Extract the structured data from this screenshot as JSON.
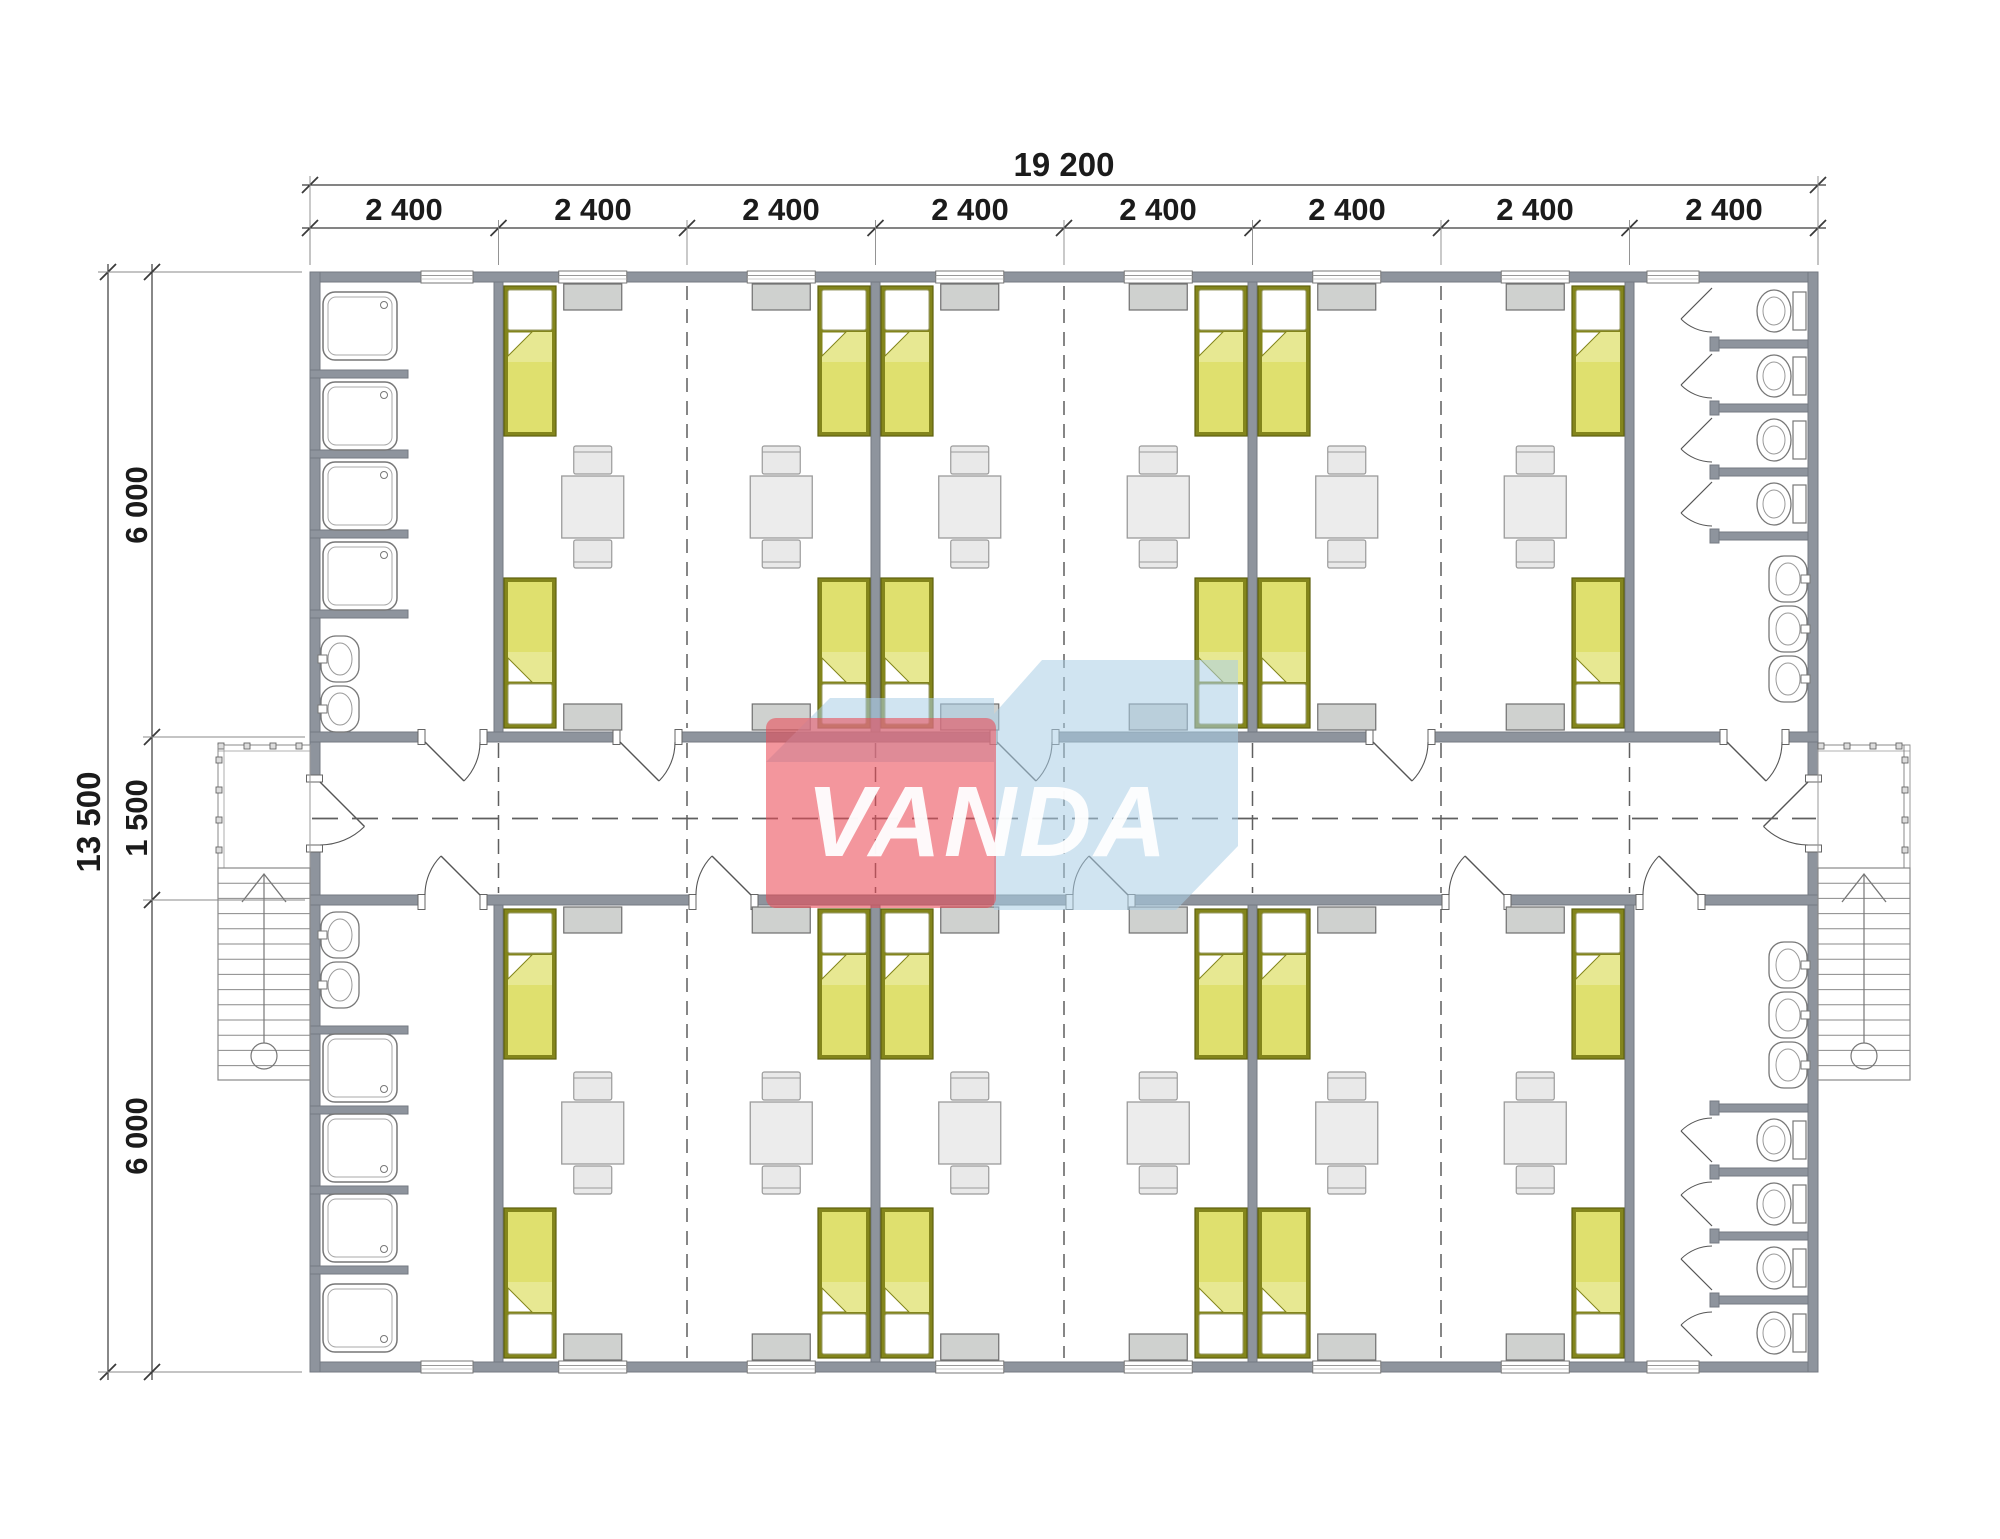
{
  "document": {
    "type": "architectural-floor-plan",
    "subject": "modular dormitory building floor plan with central corridor"
  },
  "dimensions": {
    "total_width_mm": "19 200",
    "module_widths_mm": [
      "2 400",
      "2 400",
      "2 400",
      "2 400",
      "2 400",
      "2 400",
      "2 400",
      "2 400"
    ],
    "total_depth_mm": "13 500",
    "depth_segments_mm": [
      "6 000",
      "1 500",
      "6 000"
    ]
  },
  "watermark": {
    "text": "VANDA",
    "red": "#ea4a56",
    "blue": "#a9cde6",
    "text_color": "#ffffff"
  },
  "inventory": {
    "bedrooms": 6,
    "beds": 24,
    "tables": 12,
    "chairs": 24,
    "wardrobes": 24,
    "showers": 8,
    "wash_basins": 10,
    "toilets": 8,
    "staircases": 2,
    "entrance_doors": 2,
    "corridors": 1
  },
  "colors": {
    "background": "#ffffff",
    "wall": "#8e949d",
    "wall_edge": "#747a82",
    "bed_frame": "#83851c",
    "bed_frame_edge": "#5f610e",
    "bed_blanket": "#dfe06e",
    "bed_pillow": "#ffffff",
    "furniture_fill": "#ececec",
    "furniture_edge": "#9b9b9b",
    "wardrobe_fill": "#cfd1cf",
    "wardrobe_edge": "#6f6f6f",
    "fixture_line": "#777777",
    "thin_line": "#555555",
    "dim_line": "#3a3a3a",
    "dim_text": "#1b1b1b"
  }
}
